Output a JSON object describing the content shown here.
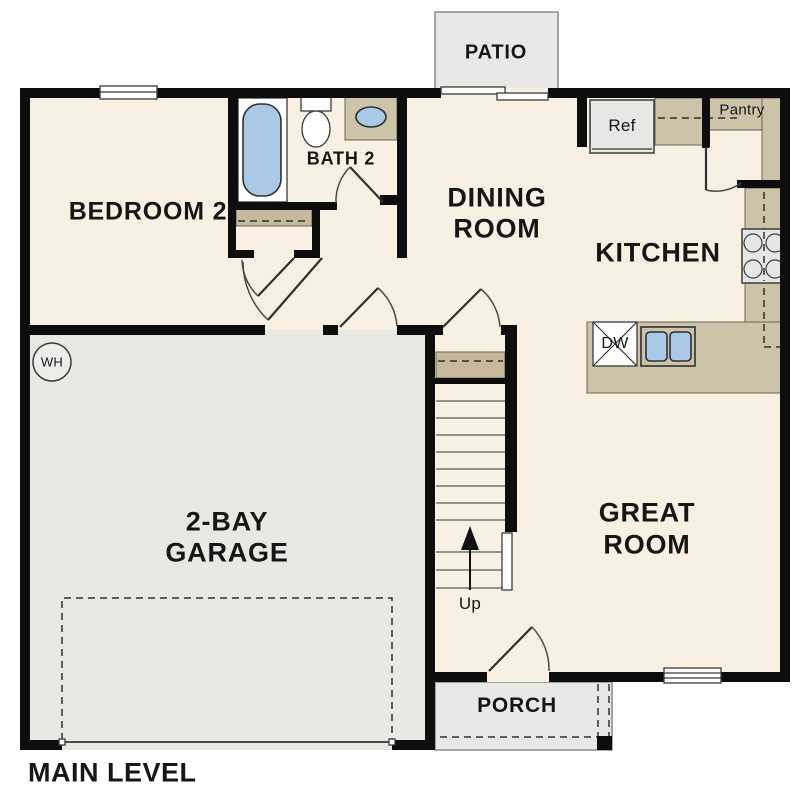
{
  "plan": {
    "title": "MAIN LEVEL",
    "labels": {
      "patio": "PATIO",
      "bedroom2": "BEDROOM 2",
      "bath2": "BATH 2",
      "dining1": "DINING",
      "dining2": "ROOM",
      "kitchen": "KITCHEN",
      "great1": "GREAT",
      "great2": "ROOM",
      "garage1": "2-BAY",
      "garage2": "GARAGE",
      "porch": "PORCH",
      "pantry": "Pantry",
      "ref": "Ref",
      "dw": "DW",
      "wh": "WH",
      "up": "Up"
    },
    "colors": {
      "wall": "#0d0d0d",
      "floor": "#f8f0e2",
      "garage": "#e9e8e5",
      "outdoor": "#e8e8e6",
      "counter": "#cdc3a9",
      "shelf": "#c6b99c",
      "blue": "#a9c9e7",
      "appliance": "#e7e7e5"
    }
  }
}
